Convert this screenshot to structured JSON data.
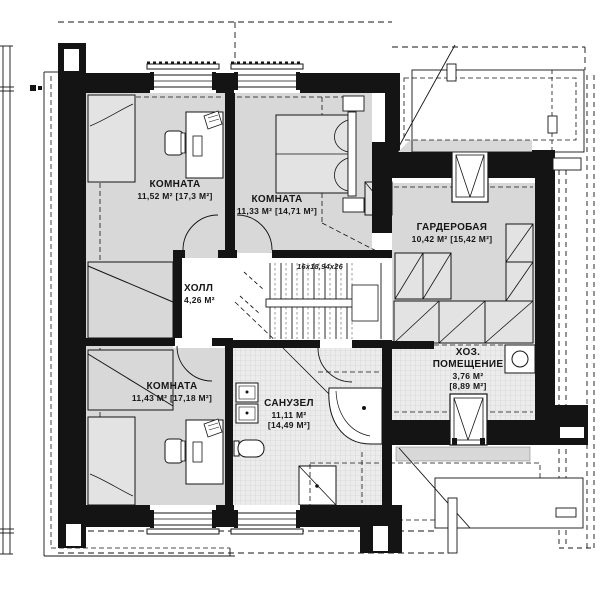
{
  "rooms": {
    "r1": {
      "name": "КОМНАТА",
      "area": "11,52 М² [17,3 М²]"
    },
    "r2": {
      "name": "КОМНАТА",
      "area": "11,33 М² [14,71 М²]"
    },
    "hall": {
      "name": "ХОЛЛ",
      "area": "4,26 М²"
    },
    "wardrobe": {
      "name": "ГАРДЕРОБАЯ",
      "area": "10,42 М² [15,42 М²]"
    },
    "r3": {
      "name": "КОМНАТА",
      "area": "11,43 М² [17,18 М²]"
    },
    "bath": {
      "name": "САНУЗЕЛ",
      "area": "11,11 М²",
      "area2": "[14,49 М²]"
    },
    "utility": {
      "name": "ХОЗ.",
      "name2": "ПОМЕЩЕНИЕ",
      "area": "3,76 М²",
      "area2": "[8,89 М²]"
    }
  },
  "stairs": {
    "label": "16x18,94x26"
  },
  "colors": {
    "wall": "#141414",
    "floor": "#d8d8d8",
    "tile_bg": "#ececec",
    "tile_line": "#c9c9c9"
  }
}
